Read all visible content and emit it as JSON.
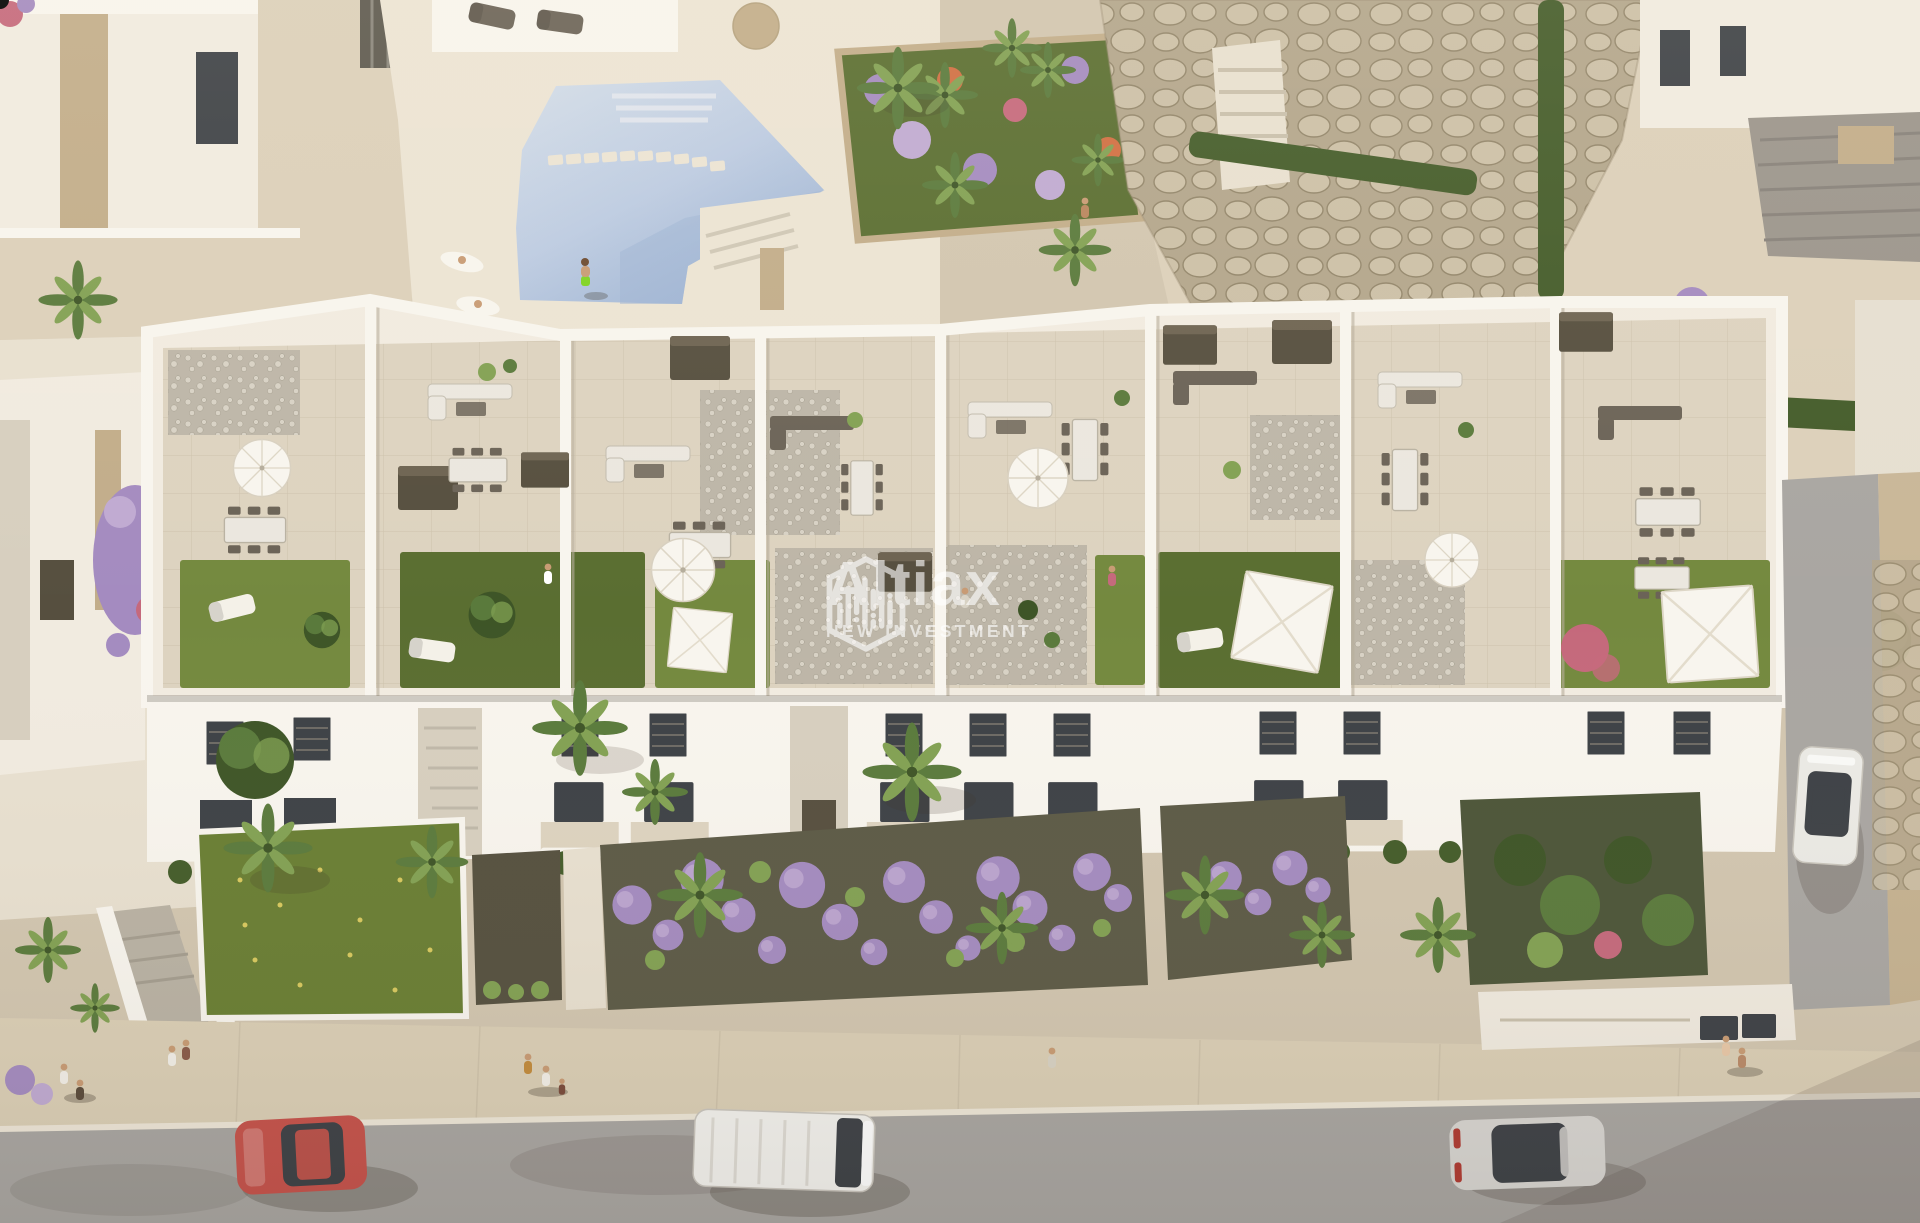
{
  "image": {
    "kind": "aerial architectural render",
    "summary": "Sunset aerial view of a new-build white apartment block with private roof terraces and lawn solariums, communal pool with stepping stones, boulder rock gardens, palm trees, front gardens with lavender bushes, and a street with cars and pedestrians."
  },
  "watermark": {
    "brand": "Altiax",
    "tagline": "NEW INVESTMENT",
    "logo_icon": "hexagon-skyline-logo",
    "color": "#ffffff",
    "opacity": 0.62
  },
  "scene": {
    "palette": {
      "sand": "#d2c6b0",
      "paving": "#e8e0d0",
      "paving_warm": "#dcd0ba",
      "deck": "#ece4d4",
      "white_sun": "#f8f5ee",
      "white_lit": "#f1ebe0",
      "white_side": "#e6dfd1",
      "white_shade": "#d7cfbf",
      "tile": "#ddd3c0",
      "tile_line": "#b9ac94",
      "pebble": "#bdb6a8",
      "pebble_dot": "#d8d2c5",
      "stone": "#c2ad8a",
      "stone_dark": "#a18c69",
      "rock_base": "#b3a68c",
      "rock_fill": "#ccc0a7",
      "rock_line": "#93866b",
      "pool_hi": "#d3dde9",
      "pool": "#bccbe2",
      "pool_deep": "#9db3d3",
      "grass": "#74893f",
      "grass_dark": "#5a6e31",
      "grass_front": "#697e33",
      "hedge": "#445c2a",
      "palm": "#5a7a3c",
      "palm_light": "#82a153",
      "foliage_dark": "#3e5527",
      "purple": "#a48bc0",
      "purple_light": "#c0aad2",
      "orange_fl": "#d06f42",
      "pink_fl": "#c5697c",
      "road": "#a9a6a2",
      "road_dark": "#95928e",
      "sidewalk": "#dbcfb6",
      "curb": "#eee7d8",
      "furn_dark": "#6b6357",
      "furn_light": "#ebe7df",
      "wood_dark": "#564f3f",
      "glass": "#3d4146",
      "skin": "#c89b74",
      "swim_shorts": "#7ed321",
      "yellow_fl": "#d8c95e"
    },
    "vehicles": {
      "red_car": "#c6524b",
      "white_van": "#f3f2ee",
      "silver_car": "#d8d6d2",
      "white_suv": "#ebeae5"
    },
    "elements": [
      "communal-pool",
      "stepping-stones",
      "flower-bed",
      "rock-garden",
      "roof-terraces",
      "lawn-solariums",
      "white-parasols",
      "square-canopies",
      "garage-ramp",
      "street",
      "sidewalk",
      "pedestrians",
      "palm-trees",
      "lavender-bushes"
    ]
  }
}
